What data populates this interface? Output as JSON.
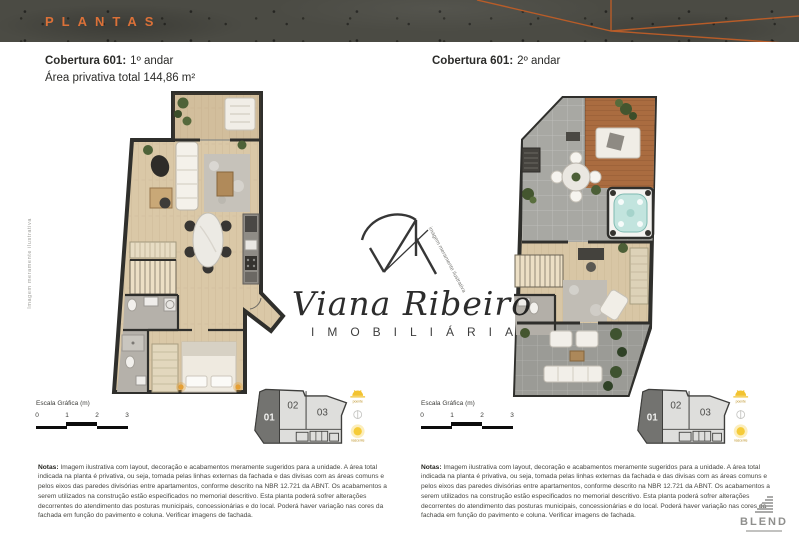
{
  "band": {
    "title": "PLANTAS"
  },
  "panels": {
    "left": {
      "title_bold": "Cobertura 601:",
      "title_floor": "1º andar",
      "area": "Área privativa total 144,86 m²",
      "side_note": "Imagem meramente ilustrativa",
      "scale_label": "Escala Gráfica (m)",
      "ticks": [
        "0",
        "1",
        "2",
        "3"
      ],
      "units": [
        "01",
        "02",
        "03"
      ],
      "sun_top": "poente",
      "sun_bottom": "nascente",
      "notes_label": "Notas:",
      "notes": "Imagem ilustrativa com layout, decoração e acabamentos meramente sugeridos para a unidade. A área total indicada na planta é privativa, ou seja, tomada pelas linhas externas da fachada e das divisas com as áreas comuns e pelos eixos das paredes divisórias entre apartamentos, conforme descrito na NBR 12.721 da ABNT. Os acabamentos a serem utilizados na construção estão especificados no memorial descritivo. Esta planta poderá sofrer alterações decorrentes do atendimento das posturas municipais, concessionárias e do local. Poderá haver variação nas cores da fachada em função do pavimento e coluna. Verificar imagens de fachada."
    },
    "right": {
      "title_bold": "Cobertura 601:",
      "title_floor": "2º andar",
      "scale_label": "Escala Gráfica (m)",
      "ticks": [
        "0",
        "1",
        "2",
        "3"
      ],
      "units": [
        "01",
        "02",
        "03"
      ],
      "sun_top": "poente",
      "sun_bottom": "nascente",
      "notes_label": "Notas:",
      "notes": "Imagem ilustrativa com layout, decoração e acabamentos meramente sugeridos para a unidade. A área total indicada na planta é privativa, ou seja, tomada pelas linhas externas da fachada e das divisas com as áreas comuns e pelos eixos das paredes divisórias entre apartamentos, conforme descrito na NBR 12.721 da ABNT. Os acabamentos a serem utilizados na construção estão especificados no memorial descritivo. Esta planta poderá sofrer alterações decorrentes do atendimento das posturas municipais, concessionárias e do local. Poderá haver variação nas cores da fachada em função do pavimento e coluna. Verificar imagens de fachada."
    }
  },
  "watermark": {
    "script": "Viana Ribeiro",
    "caps": "IMOBILIÁRIA",
    "note": "imagem meramente ilustrativa"
  },
  "brand": {
    "name": "BLEND"
  },
  "colors": {
    "accent_orange": "#DC7138",
    "band_gray": "#4B4B44",
    "wall_dark": "#2F2F2C",
    "wood_floor": "#D9C7A6",
    "terrace_tile": "#A8A8A3",
    "jacuzzi_water": "#C2E4DE",
    "sun_yellow": "#F2C330"
  }
}
